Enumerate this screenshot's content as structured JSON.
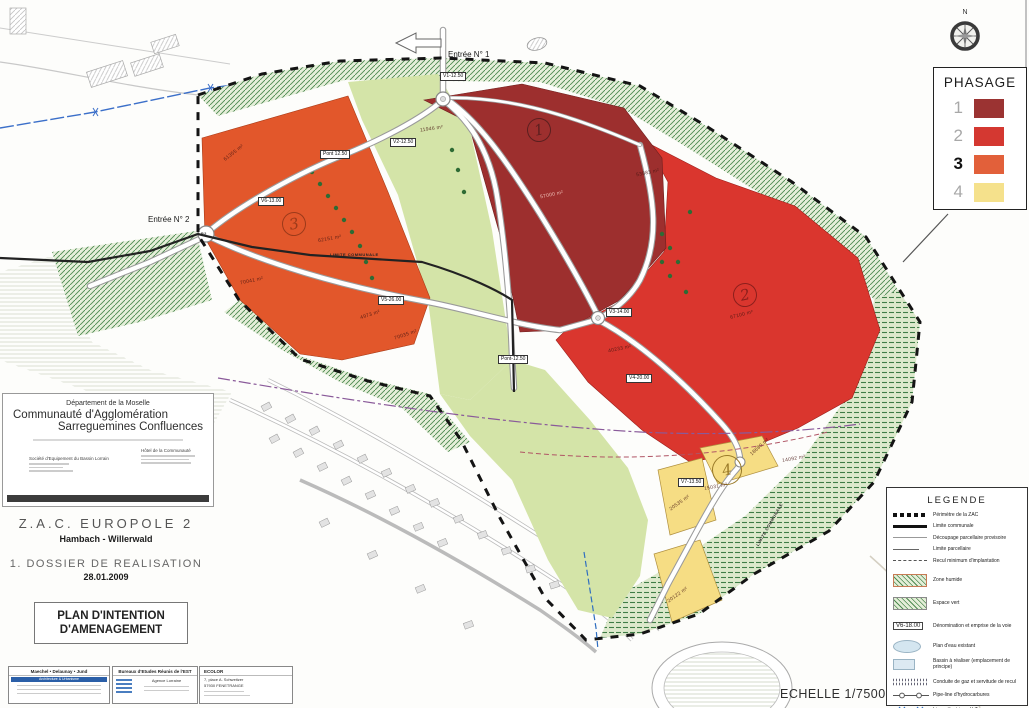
{
  "map": {
    "entrance1": "Entrée N° 1",
    "entrance2": "Entrée N° 2",
    "roads": {
      "v1": "V1-12.50",
      "v2": "V2-12.50",
      "v3": "V3-14.00",
      "v4": "V4-20.00",
      "v5": "V5-26.00",
      "v6": "V6-13.00",
      "v7": "V7-13.50",
      "pont1": "Pont 12.50",
      "pont2": "Pont-12.50"
    },
    "limite_communale_label": "LIMITE COMMUNALE",
    "p2": "P2",
    "phase_markers": [
      "1",
      "2",
      "3",
      "4"
    ],
    "parcels": [
      {
        "text": "61355 m²"
      },
      {
        "text": "11946 m²"
      },
      {
        "text": "57000 m²"
      },
      {
        "text": "53883 m²"
      },
      {
        "text": "67100 m²"
      },
      {
        "text": "62151 m²"
      },
      {
        "text": "70041 m²"
      },
      {
        "text": "4973 m²"
      },
      {
        "text": "70035 m²"
      },
      {
        "text": "40233 m²"
      },
      {
        "text": "18680 m²"
      },
      {
        "text": "15031 m²"
      },
      {
        "text": "20535 m²"
      },
      {
        "text": "20122 m²"
      },
      {
        "text": "14092 m²"
      }
    ]
  },
  "phasage": {
    "title": "PHASAGE",
    "phases": [
      {
        "label": "1",
        "color": "#9b3332"
      },
      {
        "label": "2",
        "color": "#d43831"
      },
      {
        "label": "3",
        "color": "#e2603a"
      },
      {
        "label": "4",
        "color": "#f5e18c"
      }
    ]
  },
  "legende": {
    "title": "LEGENDE",
    "road_box": "V6-18.00",
    "items": [
      "Périmètre de la ZAC",
      "Limite communale",
      "Découpage parcellaire provisoire",
      "Limite parcellaire",
      "Recul minimum d'implantation",
      "Zone humide",
      "Espace vert",
      "Dénomination et emprise de la voie",
      "Plan d'eau existant",
      "Bassin à réaliser (emplacement de principe)",
      "Conduite de gaz et servitude de recul",
      "Pipe-line d'hydrocarbures",
      "Ligne électrique H.T.",
      "Emprise de voie à créer"
    ]
  },
  "cartouche": {
    "dept": "Département de la Moselle",
    "line1": "Communauté d'Agglomération",
    "line2": "Sarreguemines Confluences",
    "org_left": "Société d'Equipement du Bassin Lorrain",
    "org_right": "Hôtel de la Communauté",
    "project": "Z.A.C.  EUROPOLE  2",
    "communes": "Hambach - Willerwald",
    "dossier": "1.  DOSSIER  DE  REALISATION",
    "date": "28.01.2009",
    "plan_title_l1": "PLAN D'INTENTION",
    "plan_title_l2": "D'AMENAGEMENT"
  },
  "footer": {
    "architects": "Maechel  • Delaunay •  Jund",
    "arch_sub": "Architecture & Urbanisme",
    "bet": "Bureaux d'Etudes Réunis de l'EST",
    "bet_sub": "Agence Lorraine",
    "eco": "ECOLOR",
    "eco_addr1": "7, place A. Schweitzer",
    "eco_addr2": "57930 FENETRANGE"
  },
  "scale": "ECHELLE 1/7500",
  "compass": {
    "north": "N"
  }
}
